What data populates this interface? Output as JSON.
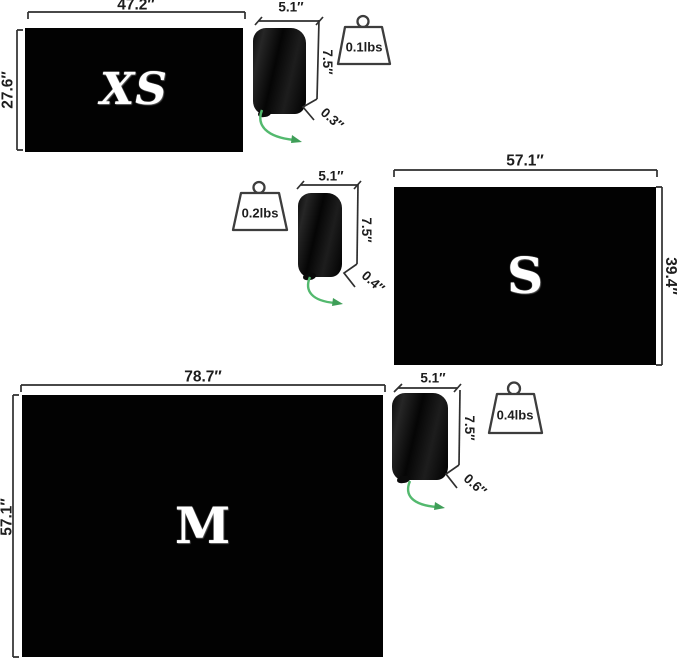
{
  "diagram_title": "mat-size-comparison",
  "colors": {
    "mat_black": "#020202",
    "dimension_line": "#2f2f2f",
    "cord_green": "#53b96e",
    "letter_white": "#ffffff",
    "background": "#ffffff"
  },
  "panels": [
    {
      "size_letter": "XS",
      "mat_width": "47.2″",
      "mat_height": "27.6″",
      "sack_width": "5.1″",
      "sack_height": "7.5″",
      "sack_depth": "0.3″",
      "weight": "0.1lbs"
    },
    {
      "size_letter": "S",
      "mat_width": "57.1″",
      "mat_height": "39.4″",
      "sack_width": "5.1″",
      "sack_height": "7.5″",
      "sack_depth": "0.4″",
      "weight": "0.2lbs"
    },
    {
      "size_letter": "M",
      "mat_width": "78.7″",
      "mat_height": "57.1″",
      "sack_width": "5.1″",
      "sack_height": "7.5″",
      "sack_depth": "0.6″",
      "weight": "0.4lbs"
    }
  ]
}
